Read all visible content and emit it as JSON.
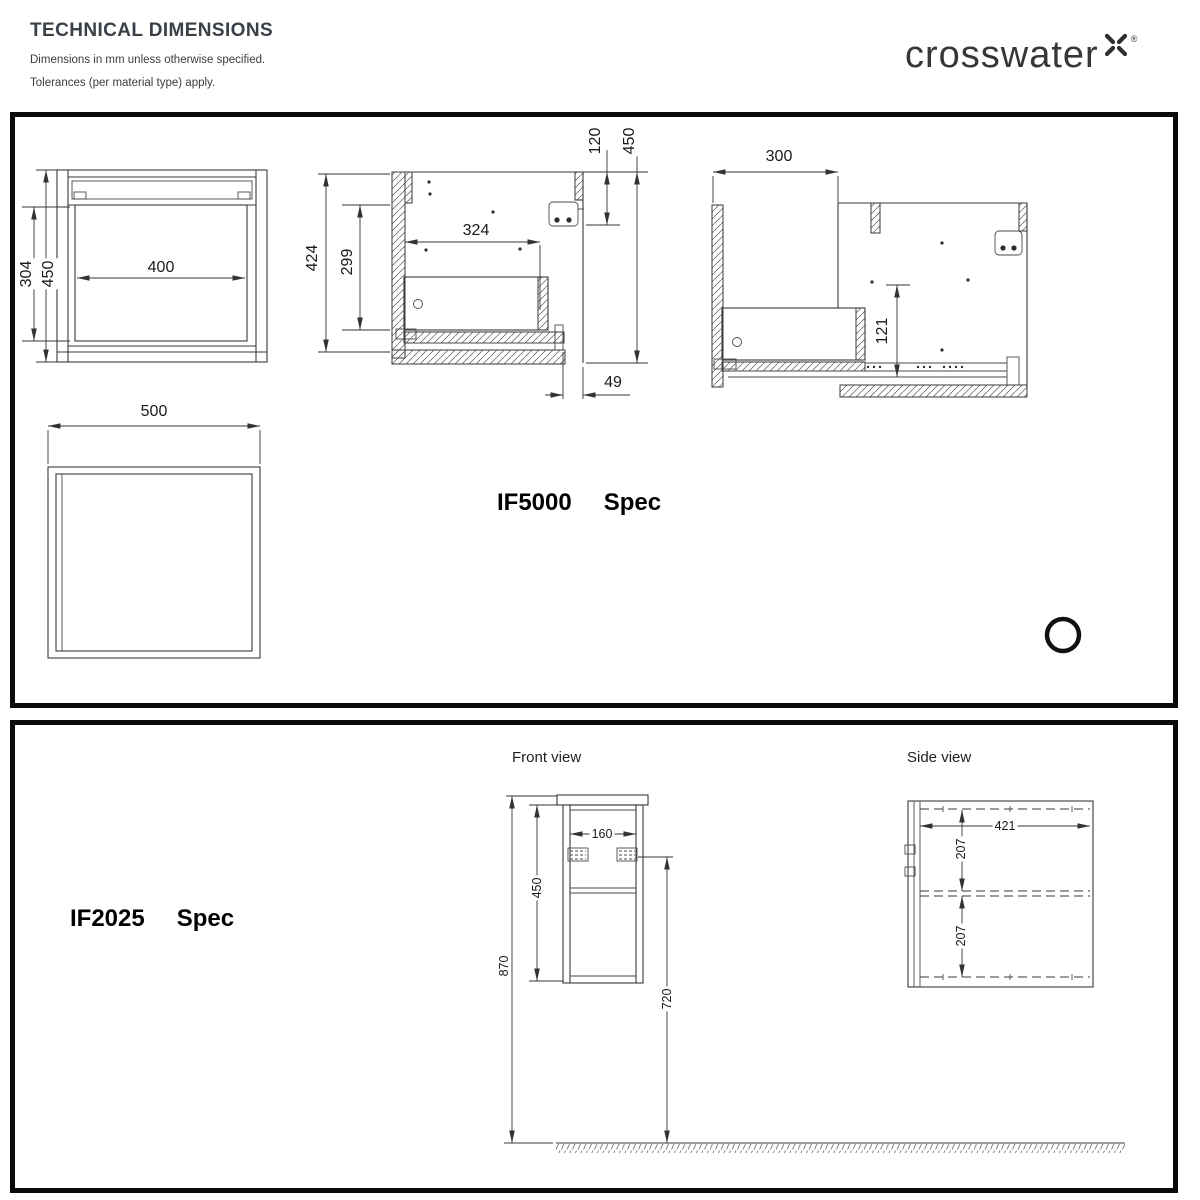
{
  "header": {
    "title": "TECHNICAL DIMENSIONS",
    "subtitle1": "Dimensions in mm unless otherwise specified.",
    "subtitle2": "Tolerances (per material type) apply.",
    "brand": "crosswater",
    "registered_mark": "®"
  },
  "if5000": {
    "model": "IF5000",
    "spec": "Spec",
    "front_view": {
      "opening_width": "400",
      "opening_height": "304",
      "overall_height": "450"
    },
    "section_view": {
      "body_height": "424",
      "inner_height": "299",
      "inner_width": "324",
      "top_fixing_offset": "120",
      "overall_height": "450",
      "plinth_recess": "49"
    },
    "extended_view": {
      "extension": "300",
      "drawer_depth": "121"
    },
    "plan_view": {
      "overall_width": "500"
    }
  },
  "if2025": {
    "model": "IF2025",
    "spec": "Spec",
    "front_view_label": "Front view",
    "side_view_label": "Side view",
    "front_view": {
      "fixing_centres": "160",
      "cabinet_height": "450",
      "overall_height": "870",
      "underside_height": "720"
    },
    "side_view": {
      "depth": "421",
      "upper_section": "207",
      "lower_section": "207"
    }
  }
}
